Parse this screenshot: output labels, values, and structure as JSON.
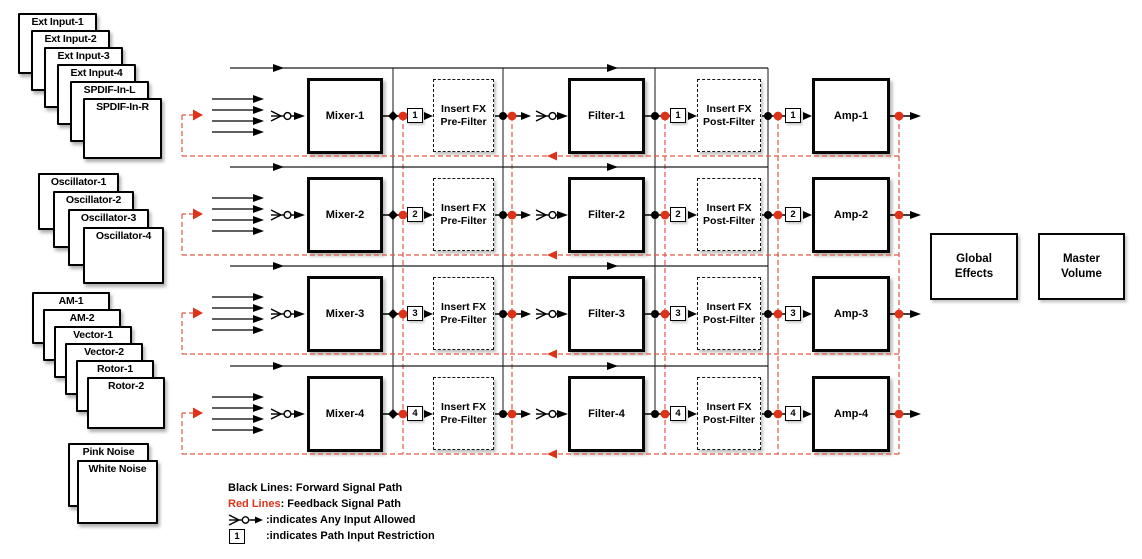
{
  "sources": [
    {
      "name": "external-inputs",
      "cards": [
        "Ext Input-1",
        "Ext Input-2",
        "Ext Input-3",
        "Ext Input-4",
        "SPDIF-In-L",
        "SPDIF-In-R"
      ]
    },
    {
      "name": "oscillators",
      "cards": [
        "Oscillator-1",
        "Oscillator-2",
        "Oscillator-3",
        "Oscillator-4"
      ]
    },
    {
      "name": "modulation-sources",
      "cards": [
        "AM-1",
        "AM-2",
        "Vector-1",
        "Vector-2",
        "Rotor-1",
        "Rotor-2"
      ]
    },
    {
      "name": "noise-sources",
      "cards": [
        "Pink Noise",
        "White Noise"
      ]
    }
  ],
  "rows": [
    {
      "mixer": "Mixer-1",
      "restriction_1": "1",
      "pre_fx_line1": "Insert FX",
      "pre_fx_line2": "Pre-Filter",
      "filter": "Filter-1",
      "restriction_2": "1",
      "post_fx_line1": "Insert FX",
      "post_fx_line2": "Post-Filter",
      "restriction_3": "1",
      "amp": "Amp-1"
    },
    {
      "mixer": "Mixer-2",
      "restriction_1": "2",
      "pre_fx_line1": "Insert FX",
      "pre_fx_line2": "Pre-Filter",
      "filter": "Filter-2",
      "restriction_2": "2",
      "post_fx_line1": "Insert FX",
      "post_fx_line2": "Post-Filter",
      "restriction_3": "2",
      "amp": "Amp-2"
    },
    {
      "mixer": "Mixer-3",
      "restriction_1": "3",
      "pre_fx_line1": "Insert FX",
      "pre_fx_line2": "Pre-Filter",
      "filter": "Filter-3",
      "restriction_2": "3",
      "post_fx_line1": "Insert FX",
      "post_fx_line2": "Post-Filter",
      "restriction_3": "3",
      "amp": "Amp-3"
    },
    {
      "mixer": "Mixer-4",
      "restriction_1": "4",
      "pre_fx_line1": "Insert FX",
      "pre_fx_line2": "Pre-Filter",
      "filter": "Filter-4",
      "restriction_2": "4",
      "post_fx_line1": "Insert FX",
      "post_fx_line2": "Post-Filter",
      "restriction_3": "4",
      "amp": "Amp-4"
    }
  ],
  "output_blocks": {
    "global_effects_line1": "Global",
    "global_effects_line2": "Effects",
    "master_volume_line1": "Master",
    "master_volume_line2": "Volume"
  },
  "legend": {
    "black_label": "Black Lines:",
    "black_text": "Forward Signal Path",
    "red_label": "Red Lines",
    "red_text": ": Feedback Signal Path",
    "any_input_text": ":indicates Any Input Allowed",
    "restriction_symbol": "1",
    "restriction_text": ":indicates Path Input Restriction"
  },
  "colors": {
    "forward_path": "#000000",
    "bypass_line": "#1c1c1c",
    "bus_line": "#3c3c3c",
    "feedback_path": "#de3318",
    "feedback_dash": "#dd5a48"
  }
}
